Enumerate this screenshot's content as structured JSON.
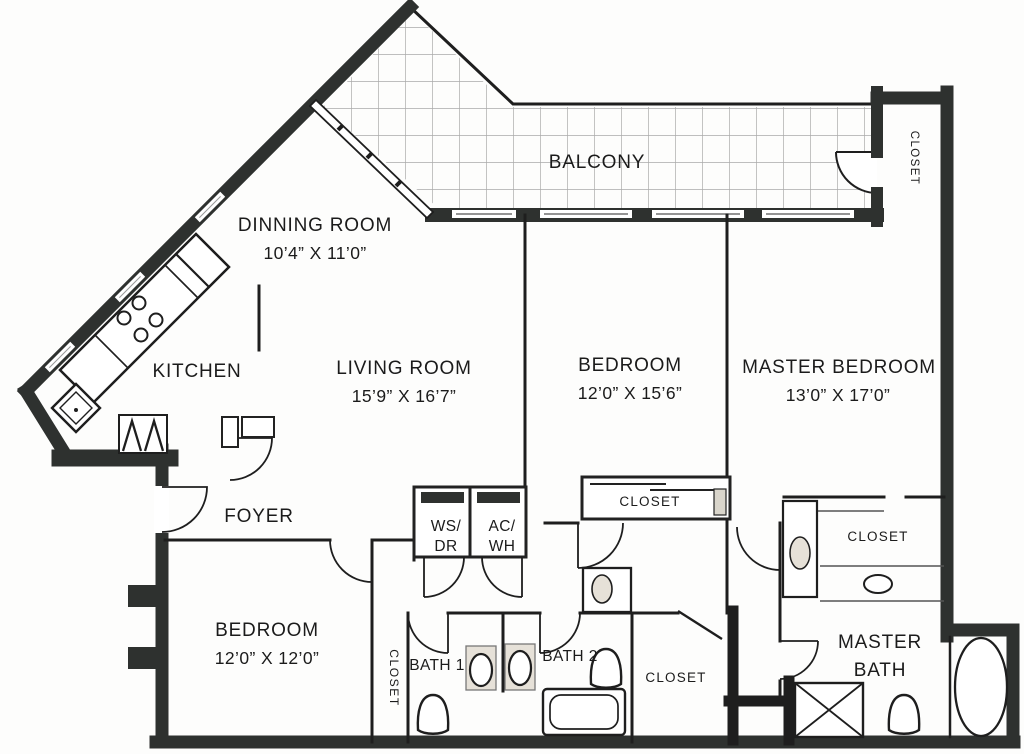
{
  "document_type": "apartment floor plan (scanned)",
  "rooms": {
    "balcony": {
      "label": "BALCONY"
    },
    "balcony_closet": {
      "label": "CLOSET"
    },
    "dining_room": {
      "label": "DINNING ROOM",
      "dimensions": "10’4” X 11’0”"
    },
    "kitchen": {
      "label": "KITCHEN"
    },
    "living_room": {
      "label": "LIVING ROOM",
      "dimensions": "15’9” X 16’7”"
    },
    "bedroom_2": {
      "label": "BEDROOM",
      "dimensions": "12’0” X 15’6”"
    },
    "master_bedroom": {
      "label": "MASTER BEDROOM",
      "dimensions": "13’0” X 17’0”"
    },
    "foyer": {
      "label": "FOYER"
    },
    "utility_washer_dryer": {
      "line1": "WS/",
      "line2": "DR"
    },
    "utility_ac_water_heater": {
      "line1": "AC/",
      "line2": "WH"
    },
    "bedroom_2_closet": {
      "label": "CLOSET"
    },
    "master_closet": {
      "label": "CLOSET"
    },
    "bedroom_3": {
      "label": "BEDROOM",
      "dimensions": "12’0” X 12’0”"
    },
    "hall_closet": {
      "label": "CLOSET"
    },
    "bath_1": {
      "label": "BATH 1"
    },
    "bath_2": {
      "label": "BATH 2"
    },
    "bath_closet": {
      "label": "CLOSET"
    },
    "master_bath": {
      "line1": "MASTER",
      "line2": "BATH"
    }
  },
  "colors": {
    "wall": "#2e312f",
    "thin_line": "#1e1e1e",
    "grid": "#aaaaaa",
    "paper": "#fdfdfc",
    "fixture_fill": "#e6e1d8"
  }
}
